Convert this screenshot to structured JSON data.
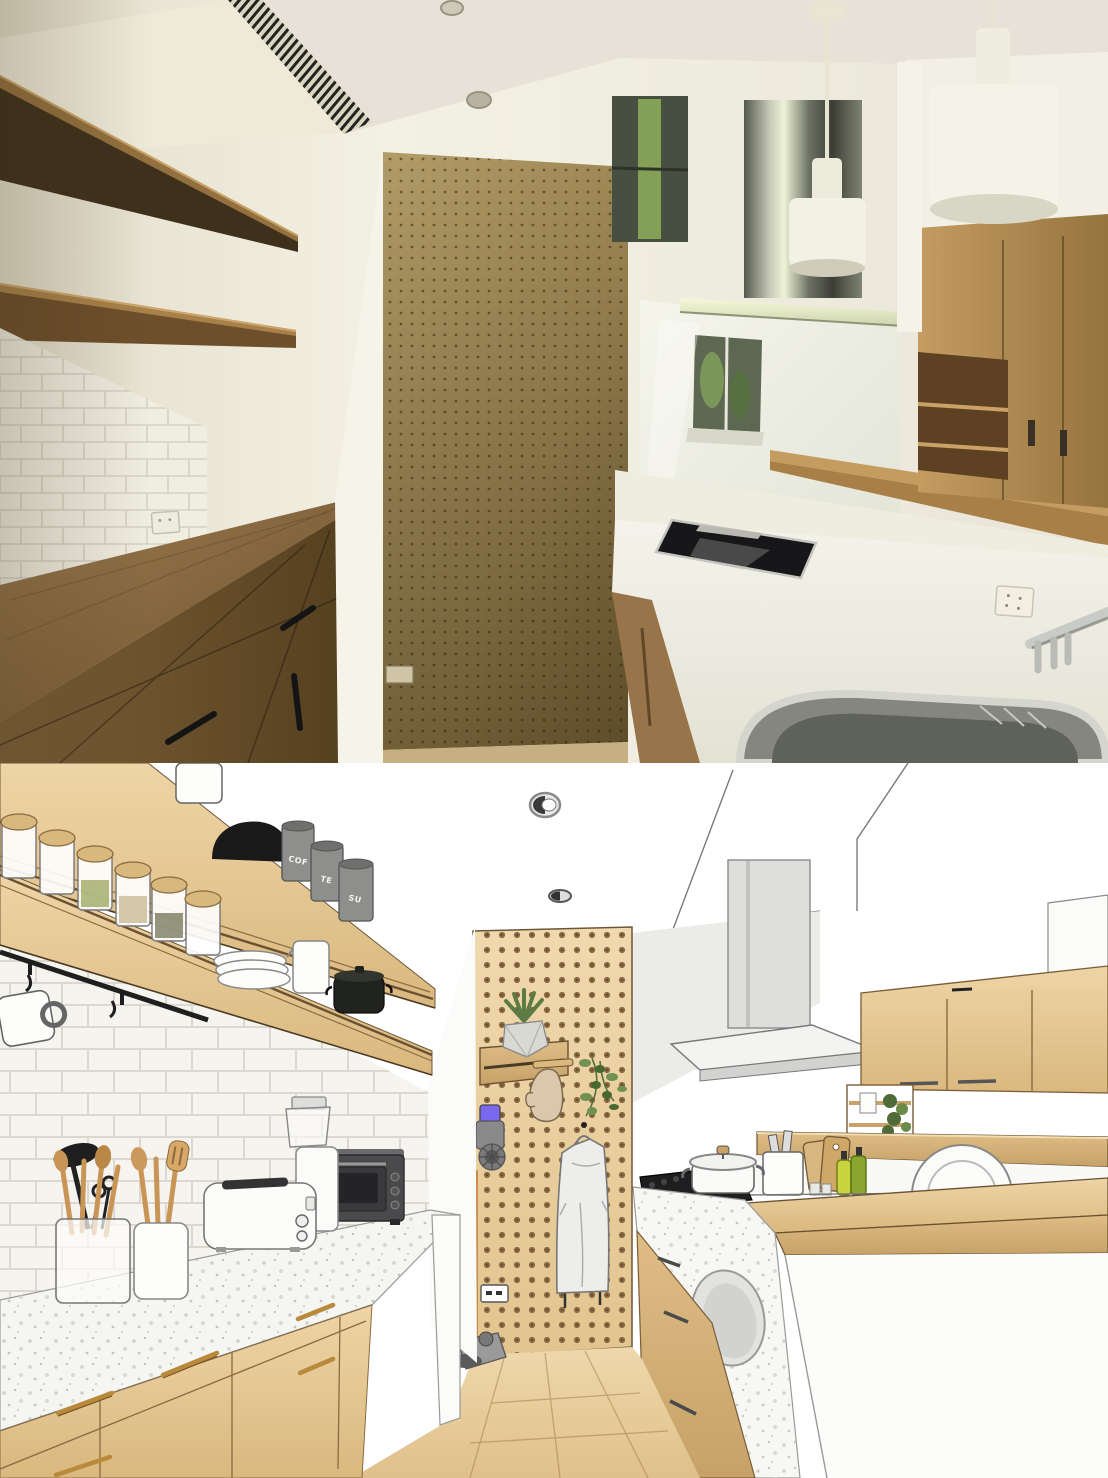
{
  "scene": {
    "kind": "before-after kitchen comparison image",
    "top_panel": "photograph of an empty galley kitchen",
    "bottom_panel": "sketch-style 3D render of the same kitchen furnished"
  },
  "labels": {
    "canister_coffee": "COF",
    "canister_tea": "TE",
    "canister_sugar": "SU"
  },
  "photo_objects": [
    "floating wood shelves",
    "subway tile backsplash",
    "wood drawer sideboard with black handles",
    "wood pegboard panel",
    "power outlets",
    "induction cooktop",
    "stainless range hood",
    "white cylinder pendant lights",
    "glossy backsplash with window reflection",
    "white quartz counter",
    "stainless sink",
    "chrome faucet",
    "wood upper cabinets with open niche",
    "wood bar ledge",
    "ceiling vent grille",
    "recessed ceiling lights"
  ],
  "render_objects": [
    "wood shelves with spice jars",
    "gray canisters",
    "black pan",
    "plate stack",
    "white jug",
    "black pot",
    "black utensil rail with mug",
    "glass utensil jar with wooden spoons",
    "ceramic utensil crock",
    "white toaster",
    "coffee grinder",
    "black toaster oven",
    "terrazzo countertop",
    "wood cabinets with brass handles",
    "pegboard with succulent, oven mitt, trailing plant and apron",
    "cordless stick vacuum",
    "wall outlet",
    "wood plank floor",
    "black cooktop with white pot",
    "raised wood bar counter",
    "cutting boards and oil bottles",
    "bell pendant lamps with chain cords",
    "flat range hood",
    "open shelf with plant",
    "recessed ceiling lights"
  ],
  "colors": {
    "photo_wall": "#ece8d8",
    "photo_ceiling": "#e8e2d8",
    "photo_shelf_wood": "#93703f",
    "photo_pegboard": "#a58d5b",
    "photo_counter_wood": "#8d6d44",
    "photo_cabinet_wood": "#b08350",
    "photo_counter_quartz": "#efeee4",
    "steel": "#b9bcb4",
    "render_wood": "#e5c48e",
    "render_pegboard": "#ecd2a4",
    "render_floor": "#ead0a2",
    "render_gray_wall": "#ebebe8",
    "brass": "#b9893c",
    "vacuum_accent_orange": "#e8883a",
    "vacuum_accent_purple": "#7b68ee",
    "plant_green": "#5d7c45"
  }
}
